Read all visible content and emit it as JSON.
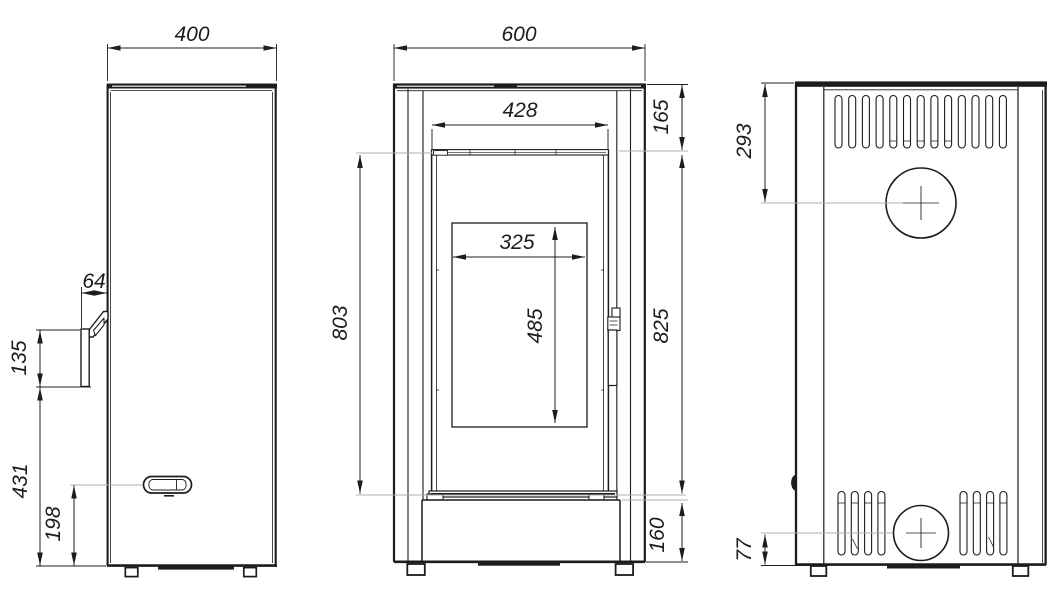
{
  "drawing": {
    "type": "technical-dimension-drawing",
    "subject": "free-standing stove shown in three orthographic views",
    "views": [
      {
        "id": "side",
        "name": "side view (left)"
      },
      {
        "id": "front",
        "name": "front view (middle)"
      },
      {
        "id": "rear",
        "name": "rear view (right)"
      }
    ],
    "units": "mm"
  },
  "dims": {
    "depth": "400",
    "handle_offset": "64",
    "handle_length": "135",
    "handle_to_floor": "431",
    "knob_height": "198",
    "width": "600",
    "door_width": "428",
    "glass_width": "325",
    "glass_height": "485",
    "door_height": "803",
    "top_to_door": "165",
    "door_zone_height": "825",
    "base_height": "160",
    "flue_center_from_top": "293",
    "outlet_center_from_floor": "77"
  },
  "colors": {
    "line": "#1c1c1c",
    "extension_line": "#aab0b3",
    "background": "#ffffff"
  }
}
